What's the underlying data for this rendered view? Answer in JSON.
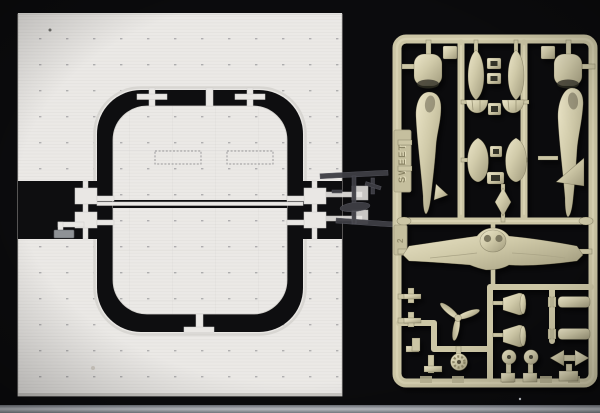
{
  "photo": {
    "subject": "plastic model kit contents photographed on a black backdrop",
    "left_assembly": {
      "description": "white styrene carrier flight-deck plates with central elevator insert, split into halves and joined by sprue gates",
      "parts": [
        "deck plate upper half",
        "deck plate lower half",
        "elevator plate upper half",
        "elevator plate lower half",
        "sprue gates",
        "metal clip"
      ]
    },
    "dark_runner": {
      "description": "barely visible dark-gray small-parts runner between the deck and the tan sprue",
      "parts": [
        "thin runner bars",
        "tiny propeller",
        "tiny fuselage"
      ]
    },
    "sprue": {
      "brand_text": "SWEET",
      "tab_number": "2",
      "description": "tan styrene runner of 1/144 aircraft parts",
      "parts": [
        "fuselage half left",
        "fuselage half right",
        "engine cowling left",
        "engine cowling right",
        "cowl front half x2",
        "float half x2",
        "canopy frame x4",
        "fin fairing x2",
        "diamond fairing",
        "one-piece wing with nacelle",
        "three-blade propeller",
        "radial engine",
        "wheel x2",
        "drop tank x2",
        "exhaust pipe x2",
        "finned tail float",
        "gate plates"
      ]
    }
  },
  "colors": {
    "background": "#0b0b0d",
    "deck_white": "#ebe9e6",
    "deck_edge": "#c6c4c0",
    "cutout_black": "#0e0e10",
    "runner_white": "#e9e7e4",
    "sprue_tan": "#ccc6a5",
    "sprue_tan_light": "#e2dcbd",
    "sprue_tan_dark": "#9d977a",
    "dark_parts_gray": "#3e3e44",
    "metal_clip_gray": "#8f9296",
    "table_edge_gray": "#8b9097"
  }
}
